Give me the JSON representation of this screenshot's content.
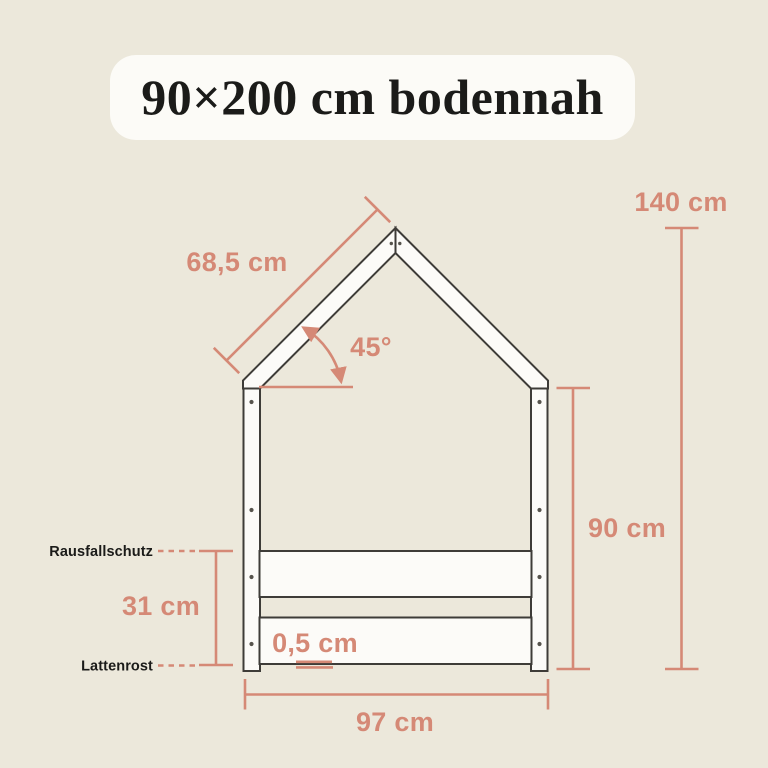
{
  "colors": {
    "background": "#ECE8DB",
    "badge": "#FCFBF7",
    "accent": "#D58976",
    "outline": "#3E3C38",
    "board": "#FCFBF8",
    "label": "#1B1B19"
  },
  "title": {
    "text": "90×200 cm bodennah"
  },
  "diagram": {
    "dimensions": {
      "roof_slope": "68,5 cm",
      "total_height": "140 cm",
      "roof_angle": "45°",
      "wall_height": "90 cm",
      "rail_height": "31 cm",
      "floor_gap": "0,5 cm",
      "outer_width": "97 cm"
    },
    "part_labels": {
      "fall_protection": "Rausfallschutz",
      "slatted_base": "Lattenrost"
    }
  }
}
